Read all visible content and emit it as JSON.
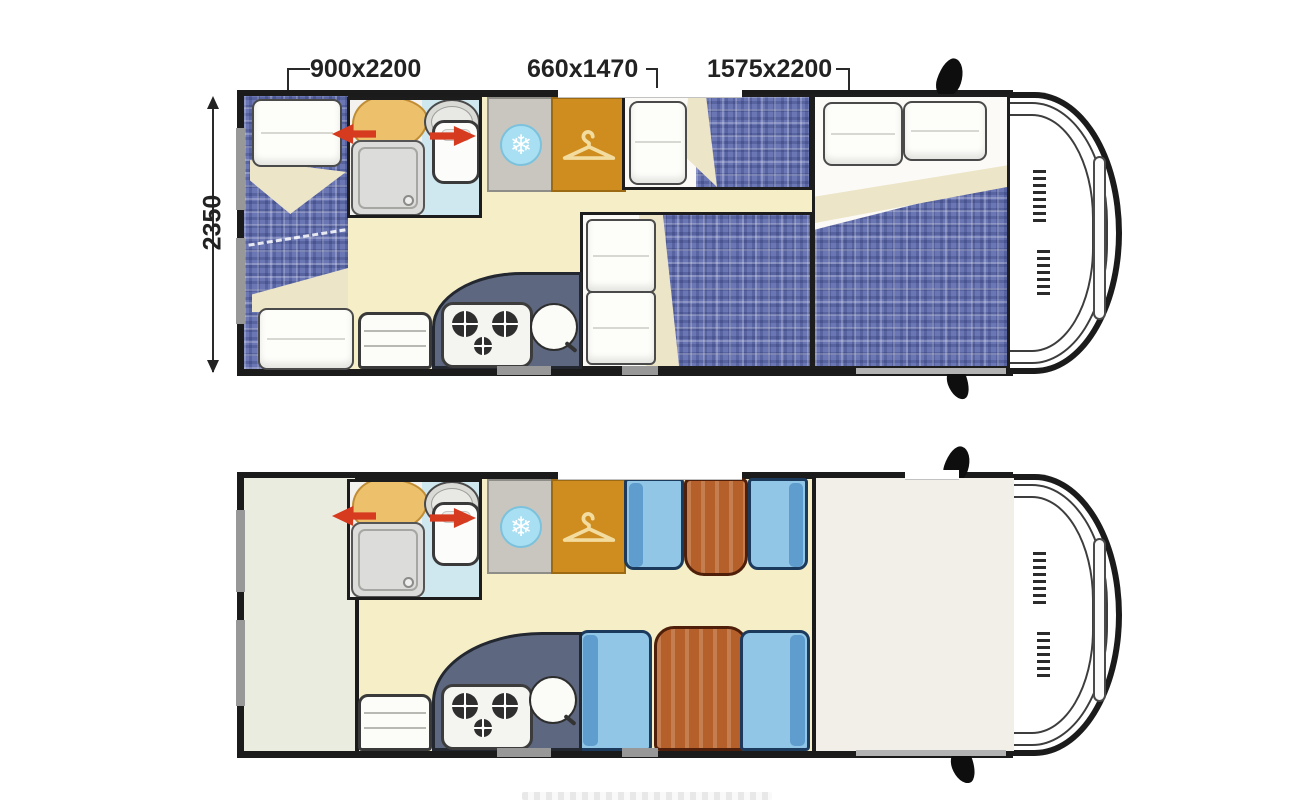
{
  "labels": {
    "bed_left": "900x2200",
    "bed_middle": "660x1470",
    "bed_overcab": "1575x2200",
    "body_width": "2350"
  },
  "icons": {
    "fridge_glyph": "❄",
    "fridge_icon": "snowflake-icon",
    "wardrobe_icon": "hanger-icon",
    "door_arrow_icon": "red-swing-arrow-icon",
    "mirror_icon": "side-mirror-icon"
  },
  "colors": {
    "wall": "#1b1b1b",
    "floor": "#f6eec6",
    "plaid_blue": "#6b77b5",
    "blanket_fold": "#ece5c8",
    "bathroom_floor": "#cfe7ee",
    "kitchen_counter": "#5d6880",
    "fridge_gray": "#c9c6c0",
    "wardrobe_amber": "#cf8d1f",
    "seat_blue": "#92c6e6",
    "seat_back_blue": "#5e9dcd",
    "table_wood": "#b5602a",
    "table_border": "#4f1f0a",
    "arrow_red": "#d63b20",
    "rear_area": "#ebece0",
    "overcab_area": "#f1efe7",
    "dim_text": "#222222"
  }
}
